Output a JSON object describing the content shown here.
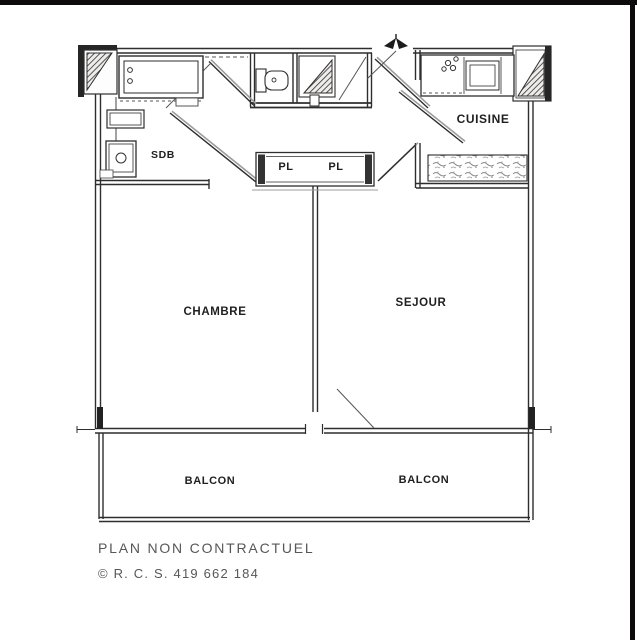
{
  "plan": {
    "rooms": {
      "sdb": "SDB",
      "cuisine": "CUISINE",
      "closet_left": "PL",
      "closet_right": "PL",
      "chambre": "CHAMBRE",
      "sejour": "SEJOUR",
      "balcon_left": "BALCON",
      "balcon_right": "BALCON"
    },
    "footer": {
      "disclaimer": "PLAN NON CONTRACTUEL",
      "registration": "© R. C. S. 419 662 184"
    },
    "icons": {
      "north_arrow": "north-arrow-icon"
    },
    "colors": {
      "line": "#2e2e2e",
      "shadow": "#9c9c9c",
      "paper": "#ffffff",
      "frame": "#0e0b0c",
      "footer_text": "#575757"
    }
  }
}
